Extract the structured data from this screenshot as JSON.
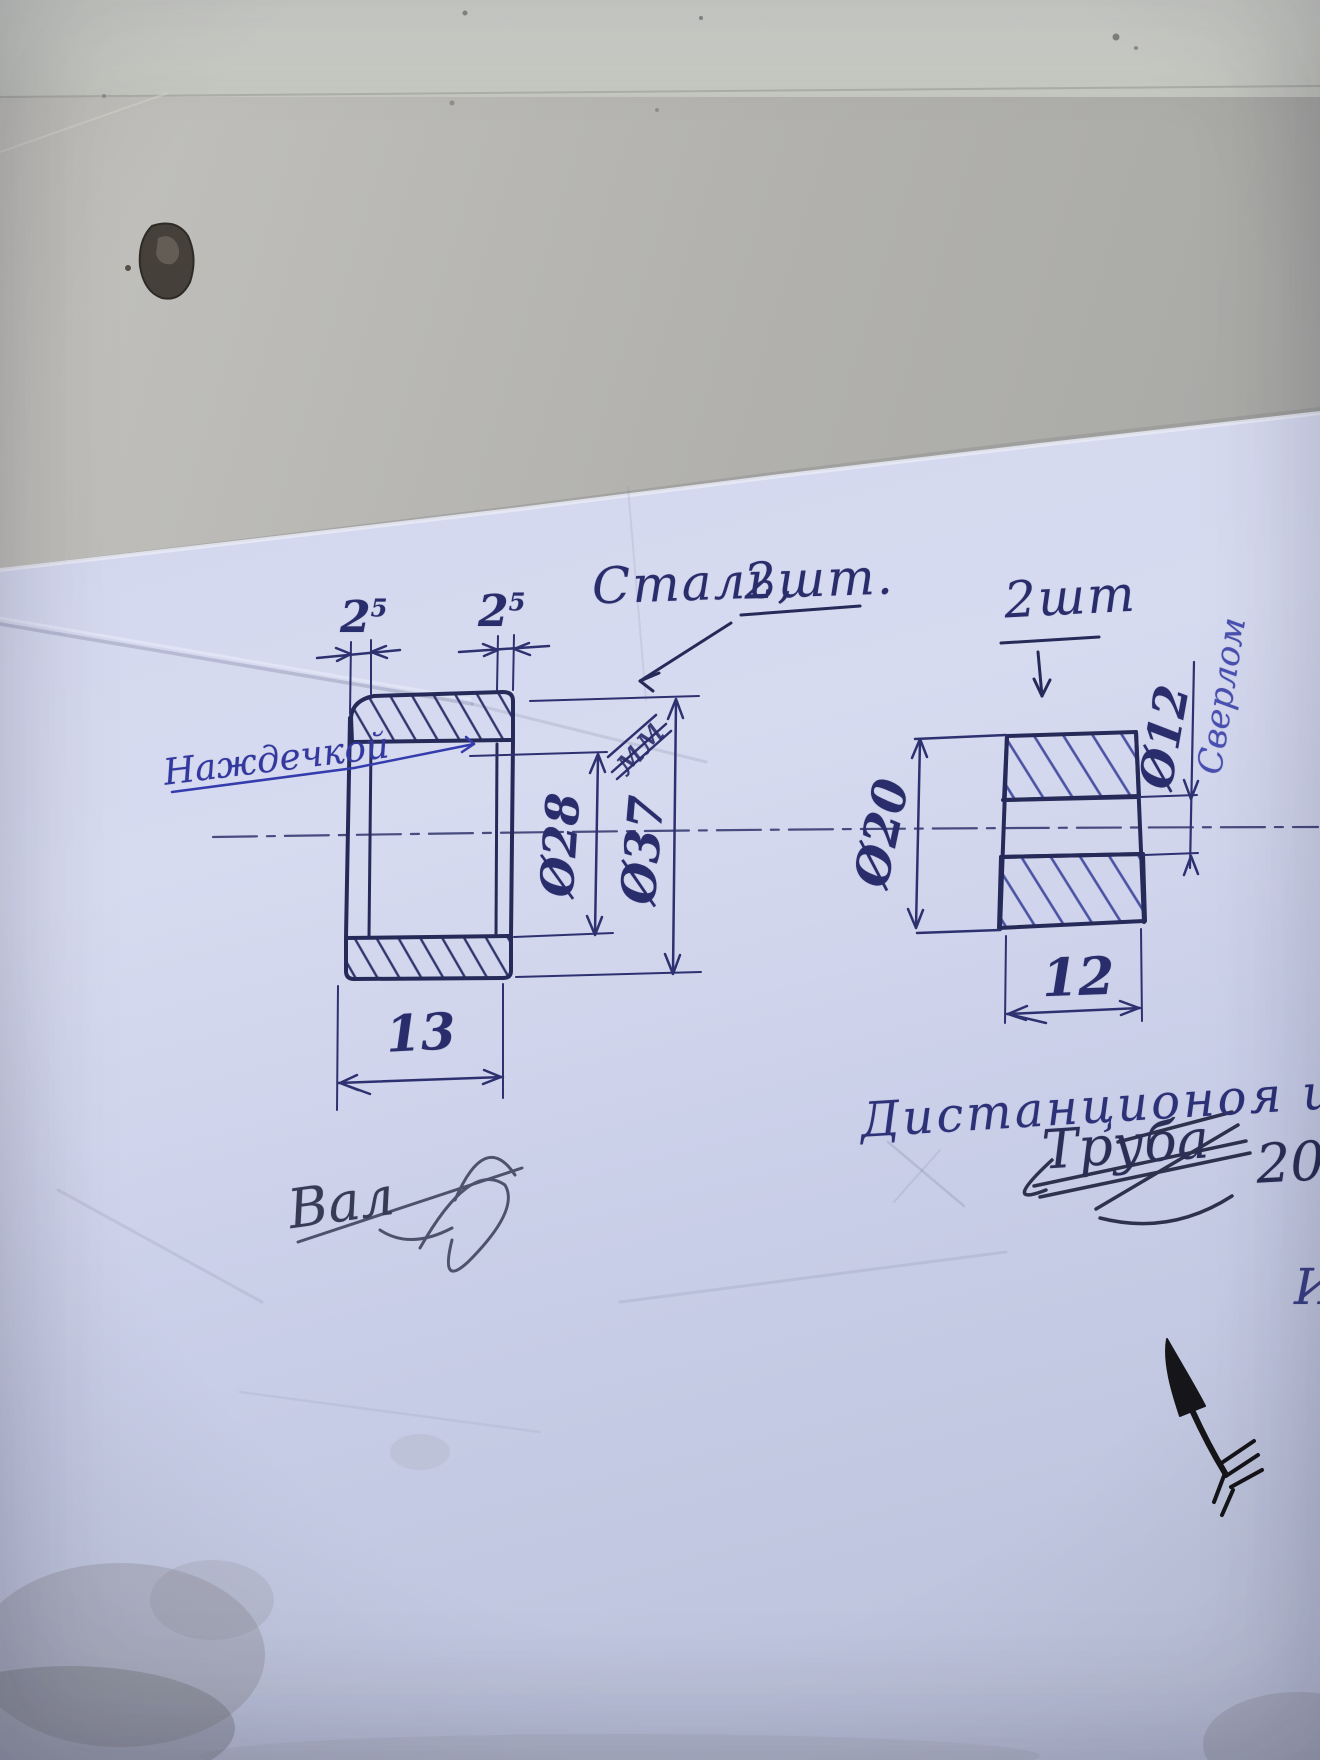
{
  "photo": {
    "material_note": {
      "text": "Сталь,",
      "qty": "2шт."
    },
    "left_part": {
      "lip_left": {
        "v": "2",
        "sup": "5"
      },
      "lip_right": {
        "v": "2",
        "sup": "5"
      },
      "bore_dia": "Ø28",
      "outer_dia": "Ø37",
      "units": "мм",
      "length": "13",
      "note": "Наждечкой"
    },
    "right_part": {
      "qty": "2шт",
      "outer_dia": "Ø20",
      "hole_dia": "Ø12",
      "drill_note": "Сверлом",
      "width": "12",
      "caption": "Дистанционоя шайба"
    },
    "struck_note": {
      "word": "Труба",
      "number": "20"
    },
    "struck_word_left": "Вал",
    "edge_letter": "И",
    "ink_color": "#262a58",
    "paper_color": "#ccd1ea"
  }
}
